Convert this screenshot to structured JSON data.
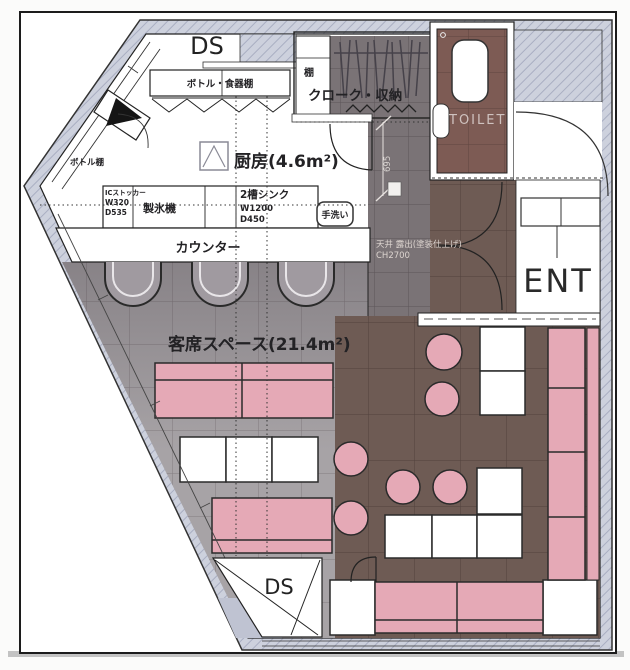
{
  "page": {
    "type": "restaurant-floor-plan"
  },
  "rooms": {
    "kitchen": {
      "label": "厨房(4.6m²)"
    },
    "seating": {
      "label": "客席スペース(21.4m²)"
    },
    "toilet": {
      "label": "TOILET"
    },
    "entrance": {
      "label": "ENT"
    },
    "cloak": {
      "label": "クローク・収納"
    },
    "closet_shelf": {
      "label": "棚"
    },
    "duct_space_top": {
      "label": "DS"
    },
    "duct_space_bottom": {
      "label": "DS"
    }
  },
  "fixtures": {
    "bottle_dish_shelf": {
      "label": "ボトル・食器棚"
    },
    "bottle_shelf": {
      "label": "ボトル棚"
    },
    "ic_stocker": {
      "label": "ICストッカー",
      "width": "W320",
      "depth": "D535"
    },
    "ice_maker": {
      "label": "製氷機"
    },
    "sink": {
      "label": "2槽シンク",
      "width": "W1200",
      "depth": "D450"
    },
    "hand_wash": {
      "label": "手洗い"
    },
    "counter": {
      "label": "カウンター"
    }
  },
  "annotations": {
    "ceiling_spec_line1": "天井 露出(塗装仕上げ)",
    "ceiling_spec_line2": "CH2700",
    "dimension_695": "695"
  },
  "colors": {
    "wall_hatch": "#cdd1dd",
    "floor_seating": "#a7a3a6",
    "floor_corridor": "#7a7376",
    "floor_walkway": "#6e5b54",
    "floor_toilet": "#7d5b54",
    "seat_pink": "#e5a9b6",
    "line": "#222222",
    "light_text": "#ded7d3"
  }
}
